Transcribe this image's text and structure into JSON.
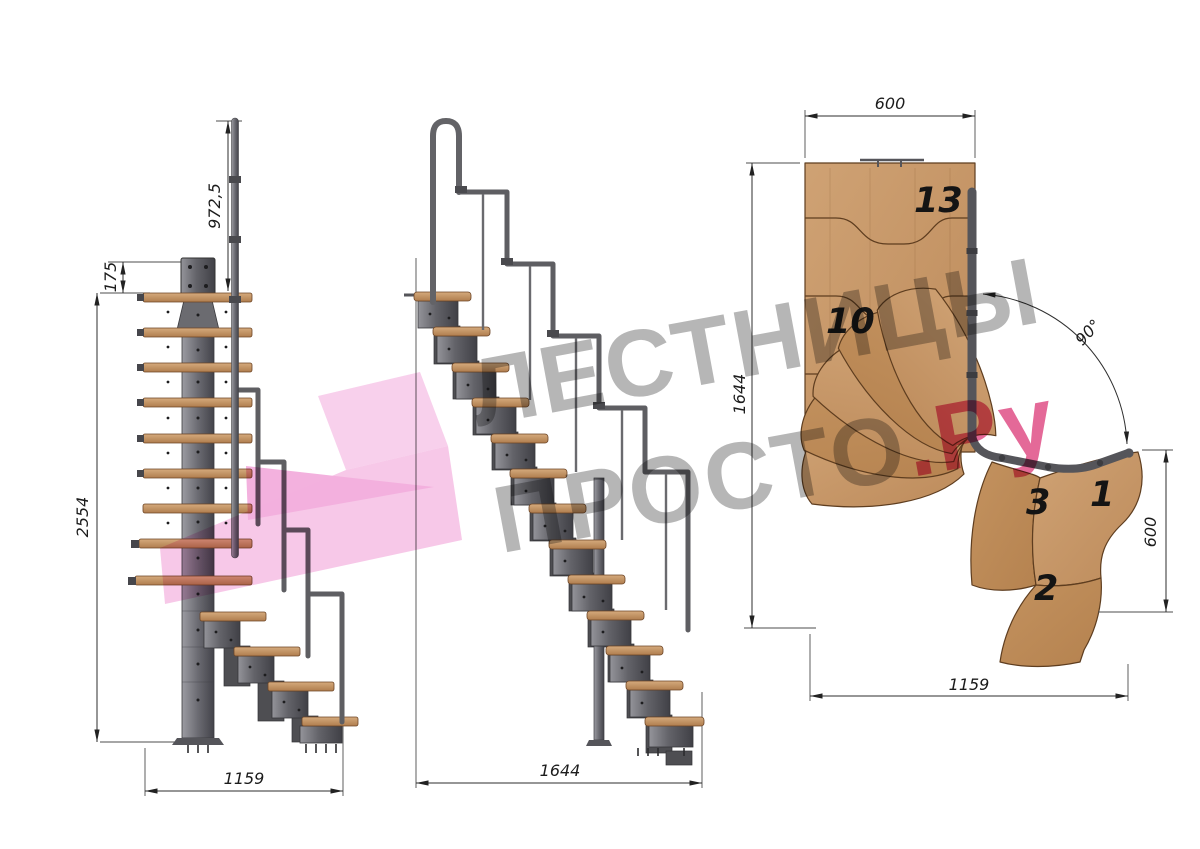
{
  "drawing": {
    "type": "staircase-technical-drawing",
    "views": {
      "side": {
        "label": "side elevation",
        "dims": {
          "rail_height": "972,5",
          "plate_offset": "175",
          "total_height": "2554",
          "base_run": "1159"
        }
      },
      "front": {
        "label": "front elevation",
        "dims": {
          "total_run": "1644"
        }
      },
      "plan": {
        "label": "top plan",
        "dims": {
          "top_width": "600",
          "left_depth": "1644",
          "turn_angle": "90°",
          "right_width": "600",
          "bottom_run": "1159"
        },
        "step_labels": {
          "top": "13",
          "upper": "10",
          "turn": "3",
          "first": "1",
          "second": "2"
        }
      }
    },
    "steps_total": 13
  },
  "watermark": {
    "line1": "ЛЕСТНИЦЫ",
    "line2": "ПРОСТО",
    "suffix": ".Ру"
  },
  "colors": {
    "wood": "#c89a6c",
    "wood_dark": "#bd8c5c",
    "metal": "#6a6a70",
    "metal_dark": "#46464c",
    "dimension_line": "#2e2e2e",
    "watermark_gray": "#7a7a7a",
    "logo_pink": "#f3b0de",
    "accent_pink": "#db3776"
  }
}
